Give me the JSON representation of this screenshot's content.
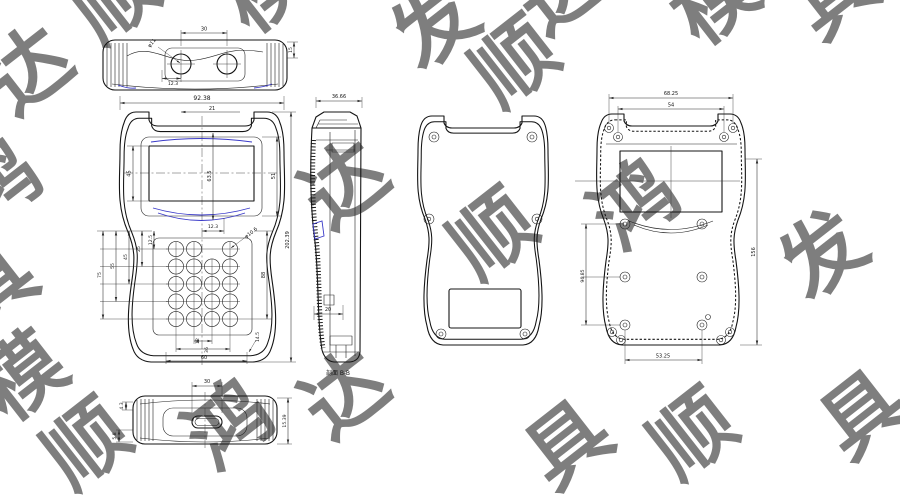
{
  "watermark": {
    "color": "#afc6e2",
    "opacity": 0.55,
    "size": 82,
    "chars": [
      "鸿",
      "顺",
      "达",
      "模",
      "具",
      "发"
    ],
    "items": [
      {
        "ch": "达",
        "x": 14,
        "y": 118,
        "r": -38
      },
      {
        "ch": "顺",
        "x": 100,
        "y": 46,
        "r": -38
      },
      {
        "ch": "模",
        "x": 250,
        "y": 36,
        "r": -38
      },
      {
        "ch": "发",
        "x": 420,
        "y": 72,
        "r": -38
      },
      {
        "ch": "达",
        "x": 545,
        "y": 38,
        "r": -38
      },
      {
        "ch": "顺",
        "x": 500,
        "y": 110,
        "r": -38
      },
      {
        "ch": "模",
        "x": 700,
        "y": 48,
        "r": -38
      },
      {
        "ch": "具",
        "x": 820,
        "y": 42,
        "r": -38
      },
      {
        "ch": "鸿",
        "x": -18,
        "y": 232,
        "r": -38
      },
      {
        "ch": "具",
        "x": -22,
        "y": 334,
        "r": -38
      },
      {
        "ch": "达",
        "x": 330,
        "y": 232,
        "r": -38
      },
      {
        "ch": "顺",
        "x": 478,
        "y": 282,
        "r": -38
      },
      {
        "ch": "鸿",
        "x": 620,
        "y": 252,
        "r": -38
      },
      {
        "ch": "发",
        "x": 808,
        "y": 302,
        "r": -38
      },
      {
        "ch": "模",
        "x": 8,
        "y": 424,
        "r": -38
      },
      {
        "ch": "顺",
        "x": 72,
        "y": 492,
        "r": -38
      },
      {
        "ch": "鸿",
        "x": 214,
        "y": 472,
        "r": -38
      },
      {
        "ch": "达",
        "x": 330,
        "y": 442,
        "r": -38
      },
      {
        "ch": "具",
        "x": 553,
        "y": 492,
        "r": -38
      },
      {
        "ch": "顺",
        "x": 678,
        "y": 482,
        "r": -38
      },
      {
        "ch": "具",
        "x": 848,
        "y": 462,
        "r": -38
      }
    ]
  },
  "views": {
    "top": {
      "width": "30",
      "hole_dia": "φ11",
      "hole_offset": "12.3",
      "edge_height": "15"
    },
    "front": {
      "w_overall": "92.38",
      "w_top": "21",
      "h_lcd": "45",
      "h_bezel": "63.5",
      "h_screen": "51",
      "d_below": "12.3",
      "key_dia": "φ10.6",
      "rows": [
        "12.5",
        "25",
        "45",
        "55",
        "75"
      ],
      "h_keypad": "88",
      "h_overall": "202.39",
      "b1": "12",
      "b2": "36",
      "b3": "60",
      "corner": "14.5"
    },
    "side": {
      "depth": "36.66",
      "inner_depth": "20",
      "caption": "剖面 B-B"
    },
    "inner": {
      "boss_w": "68.25",
      "window_w": "54",
      "boss_h": "96.85",
      "overall_h": "156",
      "bottom_w": "53.25"
    },
    "bottom": {
      "slot_w": "30",
      "lip_a": "4.3",
      "lip_b": "5.8",
      "height": "15.39"
    }
  }
}
